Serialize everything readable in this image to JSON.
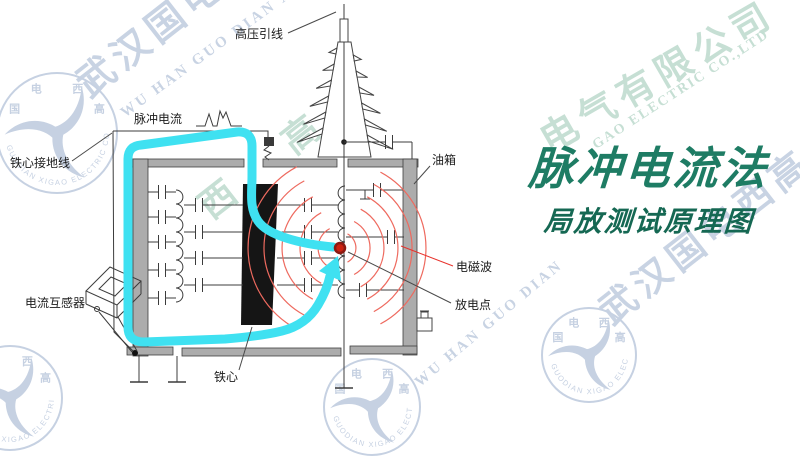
{
  "title": {
    "main": "脉冲电流法",
    "sub": "局放测试原理图"
  },
  "labels": {
    "hv_lead": "高压引线",
    "pulse_current": "脉冲电流",
    "core_ground_wire": "铁心接地线",
    "current_transformer": "电流互感器",
    "oil_tank": "油箱",
    "em_wave": "电磁波",
    "discharge_point": "放电点",
    "iron_core": "铁心"
  },
  "watermark": {
    "company_cn": "武汉国电西高电气有限公司",
    "company_en": "WU HAN GUO DIAN XI GAO ELECTRIC CO.,LTD",
    "logo_chars": "国电西高",
    "logo_ring": "GUODIAN XIGAO ELECTRIC CO.,LTD",
    "fragments": [
      {
        "text": "武汉国电",
        "size": 38,
        "x": 62,
        "y": 64,
        "rot": -38,
        "c": "blue",
        "ls": 6
      },
      {
        "text": "WU HAN GUO DIAN XI",
        "size": 15,
        "x": 118,
        "y": 108,
        "rot": -36,
        "c": "blue",
        "ls": 3
      },
      {
        "text": "西 高",
        "size": 36,
        "x": 186,
        "y": 188,
        "rot": -38,
        "c": "green",
        "ls": 30
      },
      {
        "text": "电气有限公司",
        "size": 37,
        "x": 528,
        "y": 116,
        "rot": -30,
        "c": "green",
        "ls": 7
      },
      {
        "text": "GAO ELECTRIC CO.,LTD",
        "size": 14,
        "x": 590,
        "y": 140,
        "rot": -33,
        "c": "green",
        "ls": 2
      },
      {
        "text": "武汉国电西高",
        "size": 37,
        "x": 585,
        "y": 292,
        "rot": -38,
        "c": "blue",
        "ls": 6
      },
      {
        "text": "WU HAN GUO DIAN",
        "size": 15,
        "x": 412,
        "y": 378,
        "rot": -40,
        "c": "blue",
        "ls": 3
      }
    ],
    "logos": [
      {
        "cx": 57,
        "cy": 133,
        "r": 60
      },
      {
        "cx": 589,
        "cy": 355,
        "r": 47
      },
      {
        "cx": 372,
        "cy": 407,
        "r": 48
      },
      {
        "cx": 10,
        "cy": 398,
        "r": 52
      }
    ]
  },
  "colors": {
    "accent_cyan": "#3FE1F1",
    "em_red": "#E8322C",
    "arc_red": "#EE6A5F",
    "dot_red": "#CC2211",
    "dot_ring": "#8B1A12",
    "title_teal": "#1E7C64",
    "subtitle_teal": "#156853",
    "tank_gray": "#ACACAC",
    "core_black": "#151515",
    "wm_blue": "#C6D1E2",
    "wm_green": "#C3DED2"
  }
}
